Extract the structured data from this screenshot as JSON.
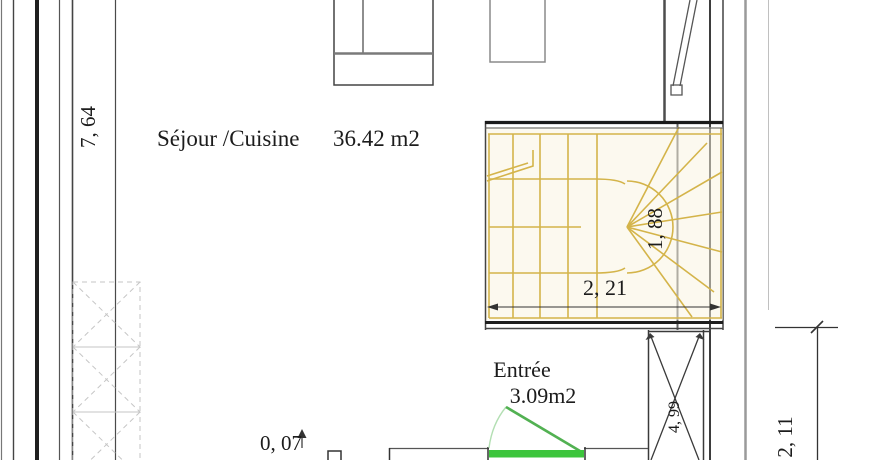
{
  "plan": {
    "title": "floor-plan-ground-level",
    "rooms": [
      {
        "name": "sejour-cuisine",
        "label": "Séjour /Cuisine",
        "area": "36.42 m2"
      },
      {
        "name": "entree",
        "label": "Entrée",
        "area": "3.09m2"
      }
    ],
    "dimensions": {
      "left_height": {
        "value": "7, 64",
        "orientation": "vertical"
      },
      "stair_width": {
        "value": "2, 21",
        "orientation": "horizontal"
      },
      "stair_winder": {
        "value": "1, 88",
        "orientation": "vertical"
      },
      "shaft_depth": {
        "value": "4, 99",
        "orientation": "vertical"
      },
      "right_lower": {
        "value": "2, 11",
        "orientation": "vertical"
      },
      "entry_offset": {
        "value": "0, 07",
        "orientation": "horizontal"
      }
    },
    "colors": {
      "stair_yellow": "#d4b44a",
      "stair_fill": "#faf4e0",
      "door_green": "#3cc53c",
      "door_leaf_green": "#52b152",
      "door_arc_green": "#b3dfb3",
      "wall_dark": "#333333",
      "wall_gray": "#999999",
      "hatch_gray": "#c6c6c6"
    }
  }
}
